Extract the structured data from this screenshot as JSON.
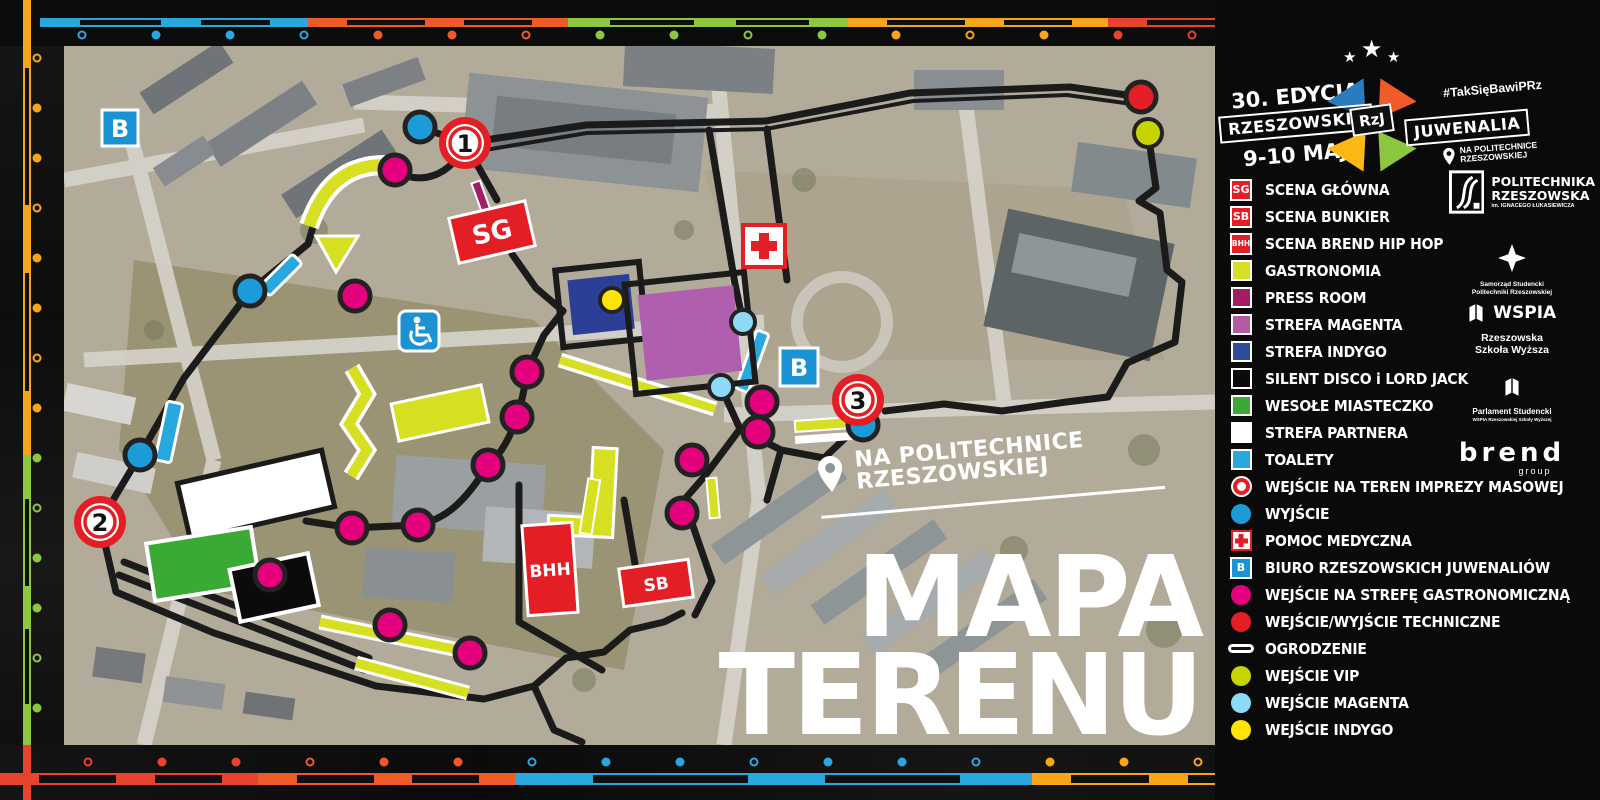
{
  "header": {
    "edition": "30. EDYCJA",
    "city": "RZESZOWSKIE",
    "logo_abbr": "RzJ",
    "event": "JUWENALIA",
    "dates": "9-10 MAJA",
    "hashtag": "#TakSięBawiPRz",
    "location_line1": "NA POLITECHNICE",
    "location_line2": "RZESZOWSKIEJ"
  },
  "map": {
    "title_line1": "MAPA",
    "title_line2": "TERENU",
    "tagline_line1": "NA POLITECHNICE",
    "tagline_line2": "RZESZOWSKIEJ",
    "labels": {
      "sg": "SG",
      "sb": "SB",
      "bhh": "BHH",
      "office": "B",
      "n1": "1",
      "n2": "2",
      "n3": "3"
    }
  },
  "legend": {
    "items": [
      {
        "icon": "badge",
        "name": "scena-glowna-badge",
        "text": "SG",
        "color": "#e31e24",
        "label": "SCENA GŁÓWNA"
      },
      {
        "icon": "badge",
        "name": "scena-bunkier-badge",
        "text": "SB",
        "color": "#e31e24",
        "label": "SCENA BUNKIER"
      },
      {
        "icon": "badge",
        "name": "scena-brend-badge",
        "text": "BHH",
        "color": "#e31e24",
        "label": "SCENA BREND HIP HOP"
      },
      {
        "icon": "square",
        "name": "gastronomia-square",
        "color": "#d7df23",
        "label": "GASTRONOMIA"
      },
      {
        "icon": "square",
        "name": "press-room-square",
        "color": "#a21e62",
        "label": "PRESS ROOM"
      },
      {
        "icon": "square",
        "name": "strefa-magenta-square",
        "color": "#b35ba5",
        "label": "STREFA MAGENTA"
      },
      {
        "icon": "square",
        "name": "strefa-indygo-square",
        "color": "#2e4b9e",
        "label": "STREFA INDYGO"
      },
      {
        "icon": "square",
        "name": "silent-disco-square",
        "color": "#0a0a0a",
        "label": "SILENT DISCO i LORD JACK"
      },
      {
        "icon": "square",
        "name": "wesole-miasteczko-square",
        "color": "#3aaa35",
        "label": "WESOŁE MIASTECZKO"
      },
      {
        "icon": "square",
        "name": "strefa-partnera-square",
        "color": "#ffffff",
        "label": "STREFA PARTNERA"
      },
      {
        "icon": "square",
        "name": "toalety-square",
        "color": "#29a8e0",
        "label": "TOALETY"
      },
      {
        "icon": "ring",
        "name": "mass-entrance-ring",
        "color": "#e31e24",
        "label": "WEJŚCIE NA TEREN IMPREZY MASOWEJ"
      },
      {
        "icon": "circle",
        "name": "exit-circle",
        "color": "#1b9cd8",
        "label": "WYJŚCIE"
      },
      {
        "icon": "cross",
        "name": "medical-cross",
        "color": "#e31e24",
        "label": "POMOC MEDYCZNA"
      },
      {
        "icon": "badge",
        "name": "biuro-badge",
        "text": "B",
        "color": "#1b92d1",
        "label": "BIURO RZESZOWSKICH JUWENALIÓW"
      },
      {
        "icon": "circle",
        "name": "gastro-entrance-circle",
        "color": "#e5007e",
        "label": "WEJŚCIE NA STREFĘ GASTRONOMICZNĄ"
      },
      {
        "icon": "circle",
        "name": "technical-entrance-circle",
        "color": "#e31e24",
        "label": "WEJŚCIE/WYJŚCIE TECHNICZNE"
      },
      {
        "icon": "line",
        "name": "fence-line",
        "color": "#141414",
        "label": "OGRODZENIE"
      },
      {
        "icon": "circle",
        "name": "vip-entrance-circle",
        "color": "#c8d400",
        "label": "WEJŚCIE VIP"
      },
      {
        "icon": "circle",
        "name": "magenta-entrance-circle",
        "color": "#8ed8f8",
        "label": "WEJŚCIE MAGENTA"
      },
      {
        "icon": "circle",
        "name": "indygo-entrance-circle",
        "color": "#ffe500",
        "label": "WEJŚCIE INDYGO"
      }
    ]
  },
  "partners": {
    "prz_line1": "POLITECHNIKA",
    "prz_line2": "RZESZOWSKA",
    "prz_line3": "im. IGNACEGO ŁUKASIEWICZA",
    "samorzad_line1": "Samorząd Studencki",
    "samorzad_line2": "Politechniki Rzeszowskiej",
    "wspia": "WSPIA",
    "wspia_line1": "Rzeszowska",
    "wspia_line2": "Szkoła Wyższa",
    "parlament_line1": "Parlament Studencki",
    "parlament_line2": "WSPIA Rzeszowskiej Szkoły Wyższej",
    "brend": "brend",
    "brend_sub": "group"
  },
  "decor": {
    "palette": {
      "blue": "#29a8e0",
      "orange": "#f05a28",
      "green": "#8dc63f",
      "yellow": "#f9a51a",
      "red": "#e8432d"
    },
    "logo_colors": {
      "blue": "#2b7bbf",
      "orange": "#f15a29",
      "yellow": "#fdb913",
      "green": "#8dc63f"
    }
  }
}
